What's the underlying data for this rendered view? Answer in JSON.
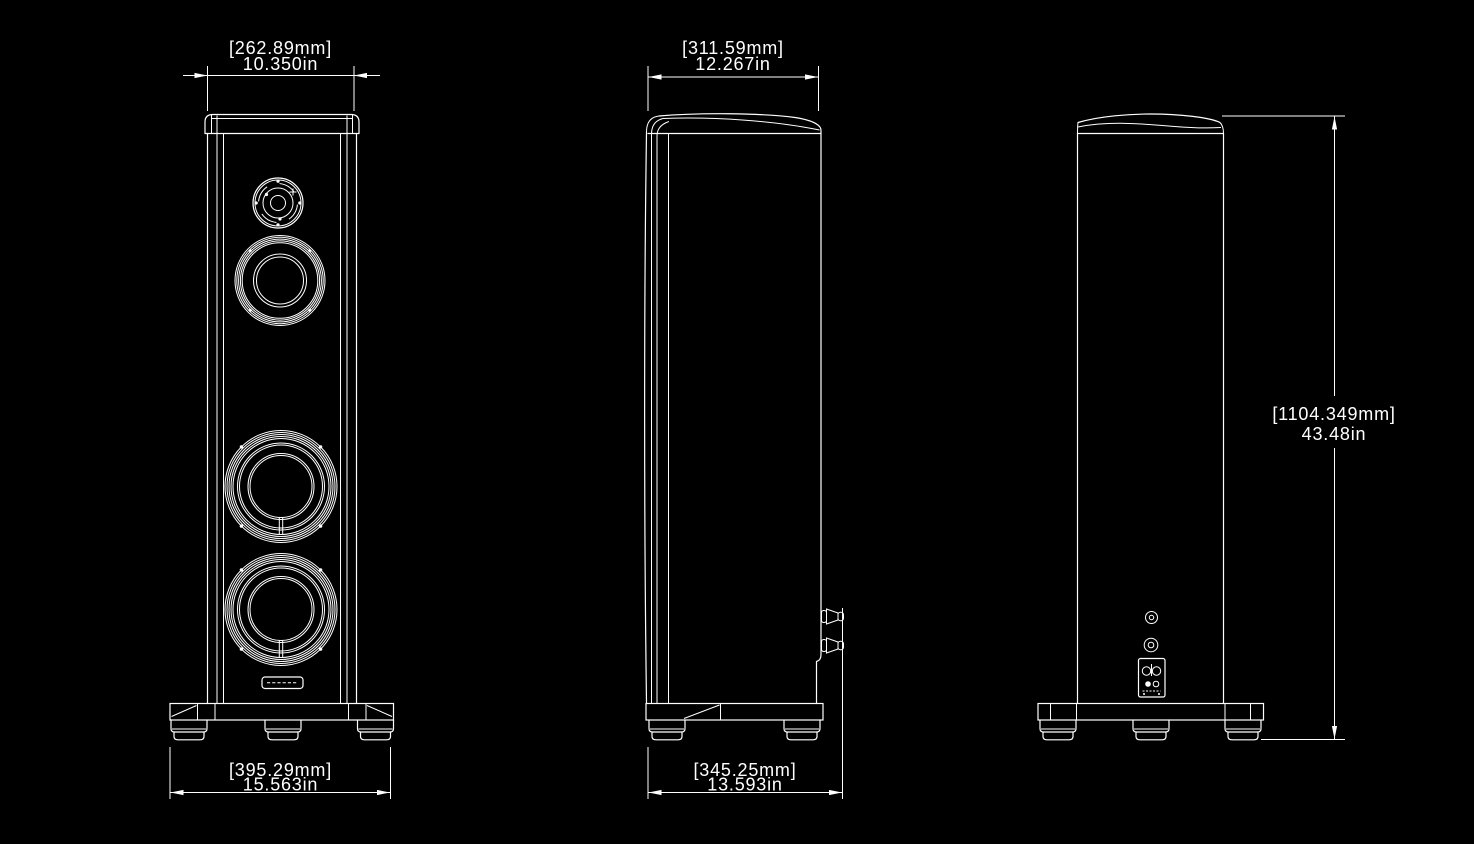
{
  "drawing": {
    "type": "loudspeaker three-view dimension drawing",
    "colors": {
      "background": "#000000",
      "line": "#ffffff"
    }
  },
  "dimensions": {
    "front_width": {
      "mm": "[262.89mm]",
      "inches": "10.350in"
    },
    "top_depth": {
      "mm": "[311.59mm]",
      "inches": "12.267in"
    },
    "overall_height": {
      "mm": "[1104.349mm]",
      "inches": "43.48in"
    },
    "base_width": {
      "mm": "[395.29mm]",
      "inches": "15.563in"
    },
    "base_depth": {
      "mm": "[345.25mm]",
      "inches": "13.593in"
    }
  }
}
